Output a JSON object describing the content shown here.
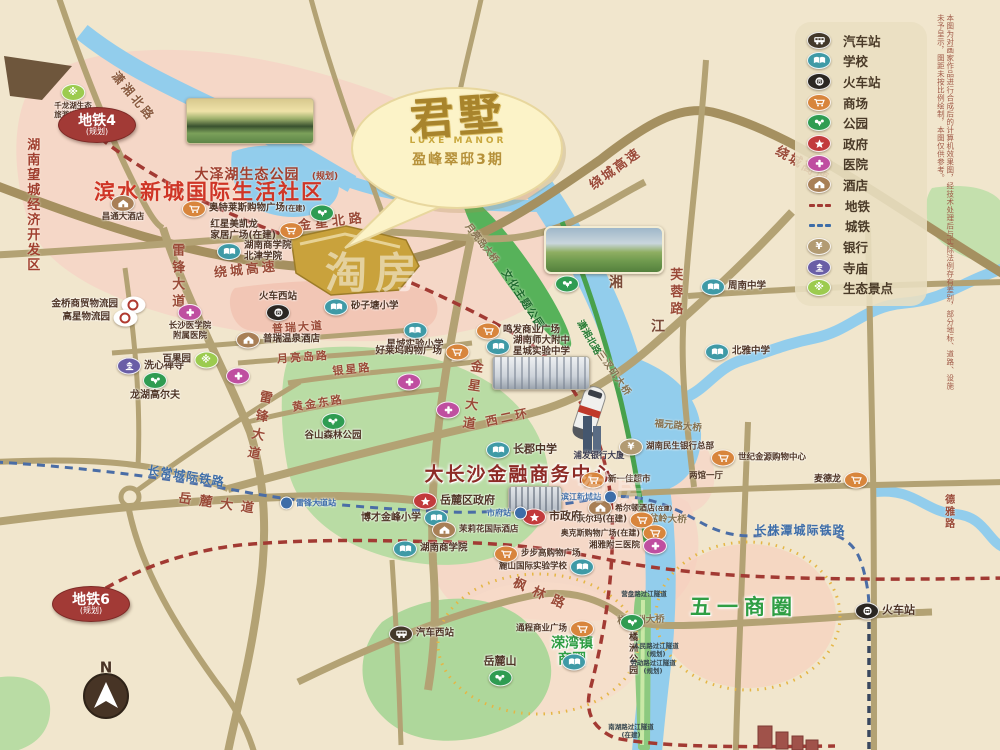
{
  "project": {
    "name": "君墅",
    "name_en": "LUXE MANOR",
    "subtitle": "盈峰翠邸3期"
  },
  "legend": {
    "items": [
      {
        "icon": "bus",
        "label": "汽车站"
      },
      {
        "icon": "school",
        "label": "学校"
      },
      {
        "icon": "train",
        "label": "火车站"
      },
      {
        "icon": "mall",
        "label": "商场"
      },
      {
        "icon": "park",
        "label": "公园"
      },
      {
        "icon": "gov",
        "label": "政府"
      },
      {
        "icon": "hospital",
        "label": "医院"
      },
      {
        "icon": "hotel",
        "label": "酒店"
      },
      {
        "icon": "metro",
        "label": "地铁"
      },
      {
        "icon": "cityrail",
        "label": "城铁"
      },
      {
        "icon": "bank",
        "label": "银行"
      },
      {
        "icon": "temple",
        "label": "寺庙"
      },
      {
        "icon": "eco",
        "label": "生态景点"
      }
    ]
  },
  "colors": {
    "metro": "#a23a33",
    "cityrail": "#3d6da8",
    "road": "#b3a274",
    "river": "#92cdec",
    "site": "#c9a23c"
  },
  "map": {
    "badges": [
      {
        "t": "地铁4",
        "sub": "(规划)",
        "x": 97,
        "y": 125
      },
      {
        "t": "地铁6",
        "sub": "(规划)",
        "x": 91,
        "y": 604
      }
    ],
    "texts": [
      {
        "t": "潇湘北路",
        "x": 133,
        "y": 97,
        "s": 12,
        "c": "#8a5a40",
        "r": 50,
        "ls": 3
      },
      {
        "t": "金星北路",
        "x": 332,
        "y": 223,
        "s": 13,
        "c": "#9a4a38",
        "r": -7,
        "ls": 4
      },
      {
        "t": "绕城高速",
        "x": 246,
        "y": 271,
        "s": 13,
        "c": "#9a4a38",
        "r": -6,
        "ls": 3
      },
      {
        "t": "绕城高速",
        "x": 616,
        "y": 170,
        "s": 13,
        "c": "#9a4a38",
        "r": -36,
        "ls": 2
      },
      {
        "t": "绕城高速",
        "x": 802,
        "y": 166,
        "s": 13,
        "c": "#9a4a38",
        "r": 30,
        "ls": 2
      },
      {
        "t": "雷锋大道",
        "x": 176,
        "y": 277,
        "s": 13,
        "c": "#9a4a38",
        "v": 1,
        "ls": 4
      },
      {
        "t": "雷锋大道",
        "x": 257,
        "y": 427,
        "s": 13,
        "c": "#9a4a38",
        "v": 1,
        "r": 12,
        "ls": 6
      },
      {
        "t": "金星大道",
        "x": 470,
        "y": 397,
        "s": 13,
        "c": "#9a4a38",
        "v": 1,
        "r": 8,
        "ls": 6
      },
      {
        "t": "普瑞大道",
        "x": 298,
        "y": 328,
        "s": 11,
        "c": "#9a4a38",
        "r": -4,
        "ls": 2
      },
      {
        "t": "月亮岛路",
        "x": 303,
        "y": 358,
        "s": 11,
        "c": "#9a4a38",
        "r": -4,
        "ls": 2
      },
      {
        "t": "银星路",
        "x": 352,
        "y": 370,
        "s": 11,
        "c": "#9a4a38",
        "r": -6,
        "ls": 2
      },
      {
        "t": "黄金东路",
        "x": 318,
        "y": 404,
        "s": 11,
        "c": "#9a4a38",
        "r": -9,
        "ls": 2
      },
      {
        "t": "西二环",
        "x": 508,
        "y": 418,
        "s": 12,
        "c": "#9a4a38",
        "r": -12,
        "ls": 3
      },
      {
        "t": "岳麓大道",
        "x": 220,
        "y": 505,
        "s": 13,
        "c": "#9a4a38",
        "r": 8,
        "ls": 8
      },
      {
        "t": "枫林路",
        "x": 542,
        "y": 596,
        "s": 13,
        "c": "#9a4a38",
        "r": 24,
        "ls": 8
      },
      {
        "t": "芙蓉路",
        "x": 674,
        "y": 293,
        "s": 13,
        "c": "#9a4a38",
        "v": 1,
        "ls": 4
      },
      {
        "t": "德雅路",
        "x": 948,
        "y": 512,
        "s": 10,
        "c": "#9a4a38",
        "v": 1,
        "ls": 2
      },
      {
        "t": "湘",
        "x": 616,
        "y": 284,
        "s": 14,
        "c": "#7a4a38"
      },
      {
        "t": "江",
        "x": 658,
        "y": 328,
        "s": 14,
        "c": "#7a4a38"
      },
      {
        "t": "三汊矶大桥",
        "x": 613,
        "y": 374,
        "s": 9.5,
        "c": "#857150",
        "r": 55,
        "ls": 1
      },
      {
        "t": "福元路大桥",
        "x": 678,
        "y": 427,
        "s": 9.5,
        "c": "#857150",
        "r": 6
      },
      {
        "t": "银盆岭大桥",
        "x": 663,
        "y": 520,
        "s": 9.5,
        "c": "#857150",
        "r": 2
      },
      {
        "t": "橘子洲大桥",
        "x": 641,
        "y": 621,
        "s": 9.5,
        "c": "#857150",
        "r": -2
      },
      {
        "t": "月亮岛大桥",
        "x": 481,
        "y": 244,
        "s": 9.5,
        "c": "#857150",
        "r": 52
      },
      {
        "t": "文化主题公园",
        "x": 522,
        "y": 300,
        "s": 10.5,
        "c": "#1e6b2e",
        "r": 57,
        "ls": 1
      },
      {
        "t": "潇湘北路",
        "x": 588,
        "y": 338,
        "s": 9.5,
        "c": "#2a7d36",
        "r": 60
      },
      {
        "t": "长常城际铁路",
        "x": 186,
        "y": 477,
        "s": 12,
        "c": "#3d6da8",
        "r": 9,
        "ls": 1
      },
      {
        "t": "长株潭城际铁路",
        "x": 800,
        "y": 531,
        "s": 12,
        "c": "#3d6da8",
        "ls": 1
      },
      {
        "t": "湖南望城经济开发区",
        "x": 31,
        "y": 205,
        "s": 13,
        "c": "#a03f2f",
        "v": 1,
        "ls": 2
      },
      {
        "t": "滨水新城国际生活社区",
        "x": 209,
        "y": 193,
        "s": 21,
        "c": "#cf3526",
        "ls": 2
      },
      {
        "t": "大泽湖生态公园",
        "x": 247,
        "y": 176,
        "s": 14,
        "c": "#a03f2f",
        "ls": 1
      },
      {
        "t": "(规划)",
        "x": 325,
        "y": 177,
        "s": 9,
        "c": "#a03f2f"
      },
      {
        "t": "大长沙金融商务中心",
        "x": 519,
        "y": 475,
        "s": 19,
        "c": "#8d2b26",
        "ls": 2,
        "halo": 1
      },
      {
        "t": "五一商圈",
        "x": 744,
        "y": 608,
        "s": 21,
        "c": "#2f9e44",
        "ls": 6,
        "halo": 1
      },
      {
        "t": "溁湾镇\n商圈",
        "x": 572,
        "y": 652,
        "s": 14,
        "c": "#2f9e44",
        "halo": 1
      },
      {
        "t": "浦发银行大厦",
        "x": 599,
        "y": 457,
        "s": 8.5,
        "c": "#3c3c50"
      },
      {
        "t": "两馆一厅",
        "x": 706,
        "y": 477,
        "s": 8.5,
        "c": "#4f3526"
      },
      {
        "t": "N",
        "x": 106,
        "y": 668,
        "s": 15,
        "c": "#4a3426"
      }
    ],
    "pois": [
      {
        "i": "bus",
        "t": "汽车西站",
        "x": 400,
        "y": 634,
        "d": "r"
      },
      {
        "i": "train",
        "t": "火车西站",
        "x": 278,
        "y": 313,
        "d": "a"
      },
      {
        "i": "train",
        "t": "火车站",
        "x": 866,
        "y": 611,
        "d": "r",
        "s": 11
      },
      {
        "i": "eco",
        "t": "千龙湖生态\n旅游度假村",
        "x": 73,
        "y": 92,
        "d": "b",
        "s": 7.5
      },
      {
        "i": "school",
        "t": "湖南商学院\n北津学院",
        "x": 228,
        "y": 252,
        "d": "r"
      },
      {
        "i": "school",
        "t": "砂子塘小学",
        "x": 335,
        "y": 307,
        "d": "r"
      },
      {
        "i": "school",
        "t": "星城实验小学",
        "x": 415,
        "y": 330,
        "d": "b"
      },
      {
        "i": "mall",
        "t": "好莱坞购物广场",
        "x": 458,
        "y": 352,
        "d": "l"
      },
      {
        "i": "school",
        "t": "湖南师大附中\n星城实验中学",
        "x": 497,
        "y": 347,
        "d": "r"
      },
      {
        "i": "mall",
        "t": "鸣发商业广场",
        "x": 487,
        "y": 331,
        "d": "r"
      },
      {
        "i": "school",
        "t": "周南中学",
        "x": 712,
        "y": 287,
        "d": "r"
      },
      {
        "i": "school",
        "t": "北雅中学",
        "x": 716,
        "y": 352,
        "d": "r"
      },
      {
        "i": "school",
        "t": "长郡中学",
        "x": 497,
        "y": 450,
        "d": "r",
        "s": 11
      },
      {
        "i": "school",
        "t": "麓山国际实验学校",
        "x": 583,
        "y": 567,
        "d": "l",
        "s": 8.5
      },
      {
        "i": "school",
        "t": "博才金峰小学",
        "x": 437,
        "y": 518,
        "d": "l",
        "s": 10
      },
      {
        "i": "school",
        "t": "湖南商学院",
        "x": 404,
        "y": 549,
        "d": "r"
      },
      {
        "i": "school",
        "t": "",
        "x": 573,
        "y": 662
      },
      {
        "i": "hotel",
        "t": "昌通大酒店",
        "x": 123,
        "y": 203,
        "d": "b",
        "s": 8.5
      },
      {
        "i": "hotel",
        "t": "普瑞温泉酒店",
        "x": 247,
        "y": 340,
        "d": "r"
      },
      {
        "i": "hotel",
        "t": "茉莉花国际酒店",
        "x": 443,
        "y": 530,
        "d": "r",
        "s": 8.5
      },
      {
        "i": "hotel",
        "t": "希尔顿酒店",
        "sub": "(在建)",
        "x": 599,
        "y": 508,
        "d": "r",
        "s": 8
      },
      {
        "i": "mall",
        "t": "奥特莱斯购物广场",
        "sub": "(在建)",
        "x": 193,
        "y": 209,
        "d": "r"
      },
      {
        "i": "mall",
        "t": "红星美凯龙\n家居广场(在建)",
        "x": 292,
        "y": 231,
        "d": "l"
      },
      {
        "i": "mall",
        "t": "沃尔玛(在建)",
        "x": 643,
        "y": 520,
        "d": "l",
        "s": 8.5
      },
      {
        "i": "mall",
        "t": "奥克斯购物广场(在建)",
        "x": 656,
        "y": 533,
        "d": "l",
        "s": 8
      },
      {
        "i": "hospital",
        "t": "湘雅附三医院",
        "x": 656,
        "y": 546,
        "d": "l",
        "s": 8.5
      },
      {
        "i": "mall",
        "t": "步步高购物广场",
        "x": 505,
        "y": 554,
        "d": "r",
        "s": 8.5
      },
      {
        "i": "mall",
        "t": "通程商业广场",
        "x": 583,
        "y": 629,
        "d": "l",
        "s": 8.5
      },
      {
        "i": "mall",
        "t": "世纪金源购物中心",
        "x": 722,
        "y": 458,
        "d": "r",
        "s": 8.5
      },
      {
        "i": "mall",
        "t": "新一佳超市",
        "x": 592,
        "y": 480,
        "d": "r",
        "s": 8.5
      },
      {
        "i": "mall",
        "t": "麦德龙",
        "x": 857,
        "y": 480,
        "d": "l",
        "s": 9
      },
      {
        "i": "bank",
        "t": "湖南民生银行总部",
        "x": 630,
        "y": 447,
        "d": "r",
        "s": 8.5
      },
      {
        "i": "gov",
        "t": "岳麓区政府",
        "x": 424,
        "y": 501,
        "d": "r",
        "s": 11
      },
      {
        "i": "gov",
        "t": "市政府",
        "x": 533,
        "y": 517,
        "d": "r",
        "s": 11
      },
      {
        "i": "hospital",
        "t": "长沙医学院\n附属医院",
        "x": 190,
        "y": 312,
        "d": "b",
        "s": 8.5
      },
      {
        "i": "hospital",
        "t": "",
        "x": 408,
        "y": 382
      },
      {
        "i": "hospital",
        "t": "",
        "x": 447,
        "y": 410
      },
      {
        "i": "hospital",
        "t": "",
        "x": 237,
        "y": 376
      },
      {
        "i": "temple",
        "t": "洗心禅寺",
        "x": 128,
        "y": 366,
        "d": "r",
        "s": 10
      },
      {
        "i": "eco",
        "t": "百果园",
        "x": 207,
        "y": 360,
        "d": "l"
      },
      {
        "i": "park",
        "t": "龙湖高尔夫",
        "x": 155,
        "y": 380,
        "d": "b",
        "s": 10
      },
      {
        "i": "park",
        "t": "谷山森林公园",
        "x": 333,
        "y": 421,
        "d": "b"
      },
      {
        "i": "park",
        "t": "岳麓山",
        "x": 500,
        "y": 678,
        "d": "a",
        "s": 11
      },
      {
        "i": "park",
        "t": "橘洲公园",
        "x": 632,
        "y": 622,
        "d": "bv",
        "s": 9
      },
      {
        "i": "park",
        "t": "",
        "x": 566,
        "y": 284
      },
      {
        "i": "park",
        "t": "",
        "x": 321,
        "y": 213
      },
      {
        "i": "logi",
        "t": "金桥商贸物流园",
        "x": 134,
        "y": 305,
        "d": "l"
      },
      {
        "i": "logi",
        "t": "高星物流园",
        "x": 126,
        "y": 318,
        "d": "l"
      },
      {
        "i": "rail",
        "t": "雷锋大道站",
        "x": 291,
        "y": 503,
        "d": "r",
        "s": 8,
        "c": "#3d6da8"
      },
      {
        "i": "rail",
        "t": "滨江新城站",
        "x": 606,
        "y": 497,
        "d": "l",
        "s": 8,
        "c": "#3d6da8"
      },
      {
        "i": "rail",
        "t": "市府站",
        "x": 516,
        "y": 513,
        "d": "l",
        "s": 8,
        "c": "#3d6da8"
      }
    ],
    "tunnels": [
      {
        "t": "营盘路过江隧道",
        "x": 644,
        "y": 595
      },
      {
        "t": "人民路过江隧道\n(规划)",
        "x": 656,
        "y": 651
      },
      {
        "t": "劳动路过江隧道\n(规划)",
        "x": 653,
        "y": 668
      },
      {
        "t": "南湖路过江隧道\n(在建)",
        "x": 631,
        "y": 732
      }
    ],
    "watermarks": [
      {
        "t": "淘房",
        "x": 375,
        "y": 270,
        "s": 42,
        "o": 0.5
      },
      {
        "t": "淘房",
        "x": 615,
        "y": 487,
        "s": 30,
        "o": 0.28
      }
    ]
  },
  "notes": {
    "disclaimer": "本图为对画家作品进行合成后的计算机效果图，经技术处理后与实际法例存有差别，部分地标、道路、设施未予呈示，图距未按比例绘制，本图仅供参考。"
  }
}
